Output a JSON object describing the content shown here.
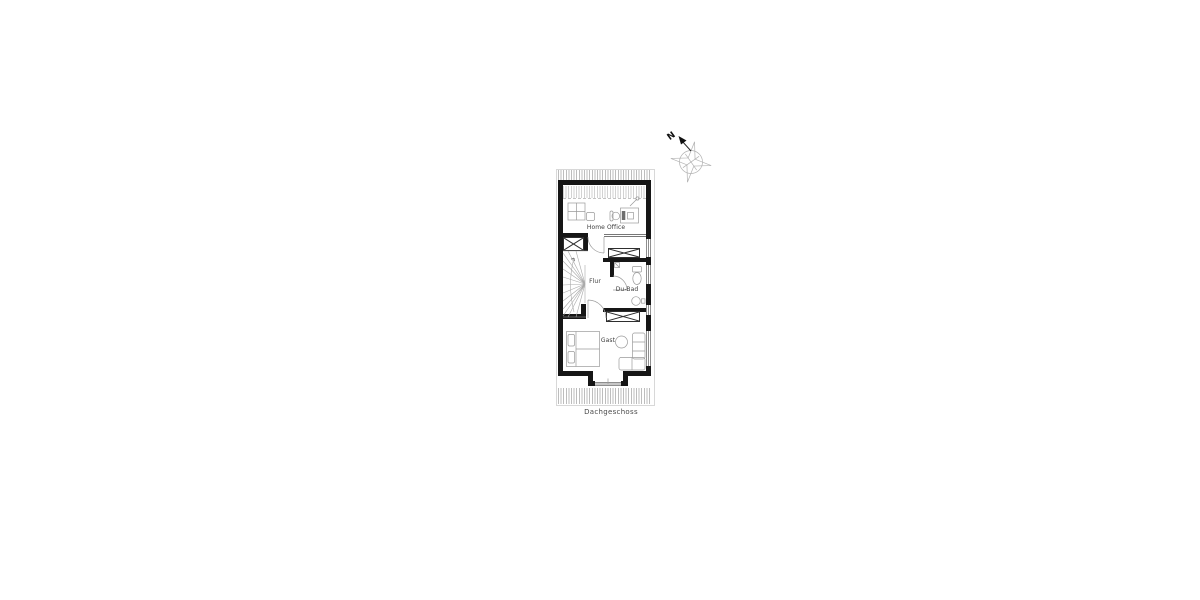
{
  "floor_plan": {
    "title": "Dachgeschoss",
    "rooms": {
      "home_office": {
        "label": "Home Office"
      },
      "flur": {
        "label": "Flur"
      },
      "du_bad": {
        "label": "Du-Bad"
      },
      "gast": {
        "label": "Gast"
      }
    },
    "compass": {
      "north_label": "N"
    },
    "colors": {
      "wall": "#161616",
      "window_line": "#8e8e8e",
      "furniture_line": "#9a9a9a",
      "eaves_hatch": "#bdbdbd",
      "label_text": "#3c3c3c",
      "background": "#ffffff"
    }
  }
}
